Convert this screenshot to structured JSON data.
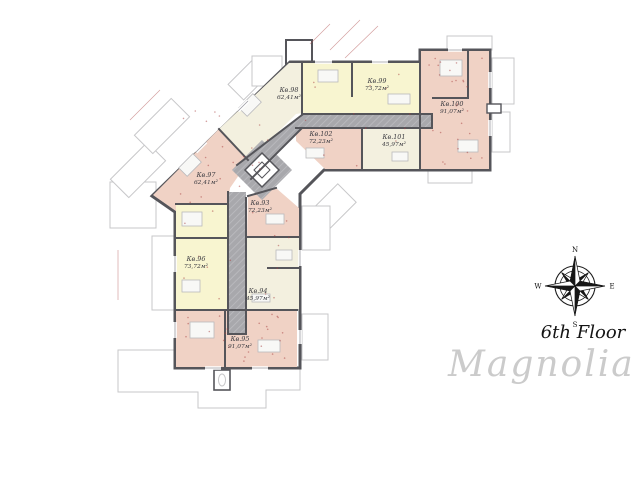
{
  "floor": {
    "label": "6th Floor"
  },
  "brand": {
    "name": "Magnolia"
  },
  "compass": {
    "north": "N",
    "east": "E",
    "south": "S",
    "west": "W"
  },
  "apartments": [
    {
      "id": "kv-93",
      "name": "Кв.93",
      "area": "72,23м²",
      "fill": "pink"
    },
    {
      "id": "kv-94",
      "name": "Кв.94",
      "area": "45,97м²",
      "fill": "cream"
    },
    {
      "id": "kv-95",
      "name": "Кв.95",
      "area": "91,07м²",
      "fill": "pink"
    },
    {
      "id": "kv-96",
      "name": "Кв.96",
      "area": "73,72м²",
      "fill": "yellow"
    },
    {
      "id": "kv-97",
      "name": "Кв.97",
      "area": "62,41м²",
      "fill": "pink"
    },
    {
      "id": "kv-98",
      "name": "Кв.98",
      "area": "62,41м²",
      "fill": "cream"
    },
    {
      "id": "kv-99",
      "name": "Кв.99",
      "area": "73,72м²",
      "fill": "yellow"
    },
    {
      "id": "kv-100",
      "name": "Кв.100",
      "area": "91,07м²",
      "fill": "pink"
    },
    {
      "id": "kv-101",
      "name": "Кв.101",
      "area": "45,97м²",
      "fill": "cream"
    },
    {
      "id": "kv-102",
      "name": "Кв.102",
      "area": "72,23м²",
      "fill": "pink"
    }
  ],
  "colors": {
    "apartment_pink": "#f0d2c5",
    "apartment_yellow": "#f8f5d0",
    "apartment_cream": "#f3f0df",
    "corridor_gray": "#a8a8ac",
    "wall_dark": "#55555a",
    "outline_light": "#c7c7c9",
    "dimension_red": "#a84040",
    "brand_gray": "#cbcbcb"
  }
}
